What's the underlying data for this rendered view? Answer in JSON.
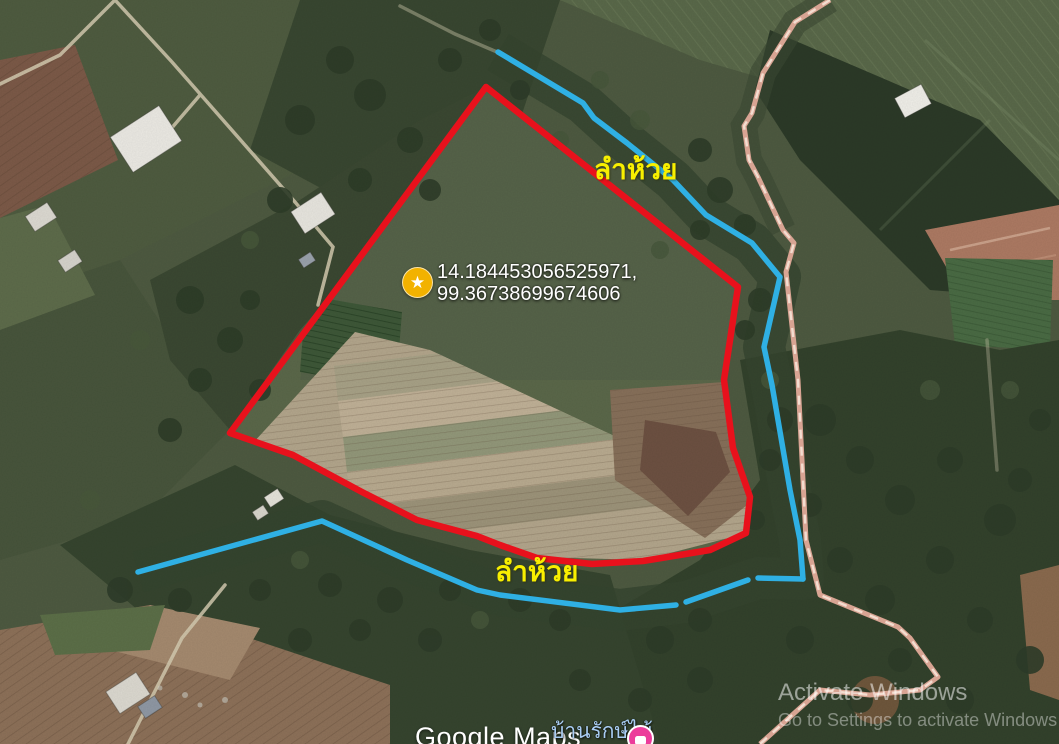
{
  "map": {
    "marker": {
      "icon": "star-icon",
      "coord_line1": "14.184453056525971,",
      "coord_line2": "99.36738699674606"
    },
    "labels": {
      "stream_top": "ลำห้วย",
      "stream_bottom": "ลำห้วย",
      "place_name": "บ้านรักษ์ไม้"
    },
    "watermark_brand": "Google Maps",
    "colors": {
      "boundary_red": "#e8111c",
      "stream_blue": "#2fb0e4",
      "road_tan": "#d8a493",
      "road_tan_dash": "#f3ddd0",
      "label_yellow": "#f8ef00",
      "marker_gold": "#f2b200",
      "poi_pink": "#ec3c9b"
    }
  },
  "os_watermark": {
    "line1": "Activate Windows",
    "line2": "Go to Settings to activate Windows"
  }
}
